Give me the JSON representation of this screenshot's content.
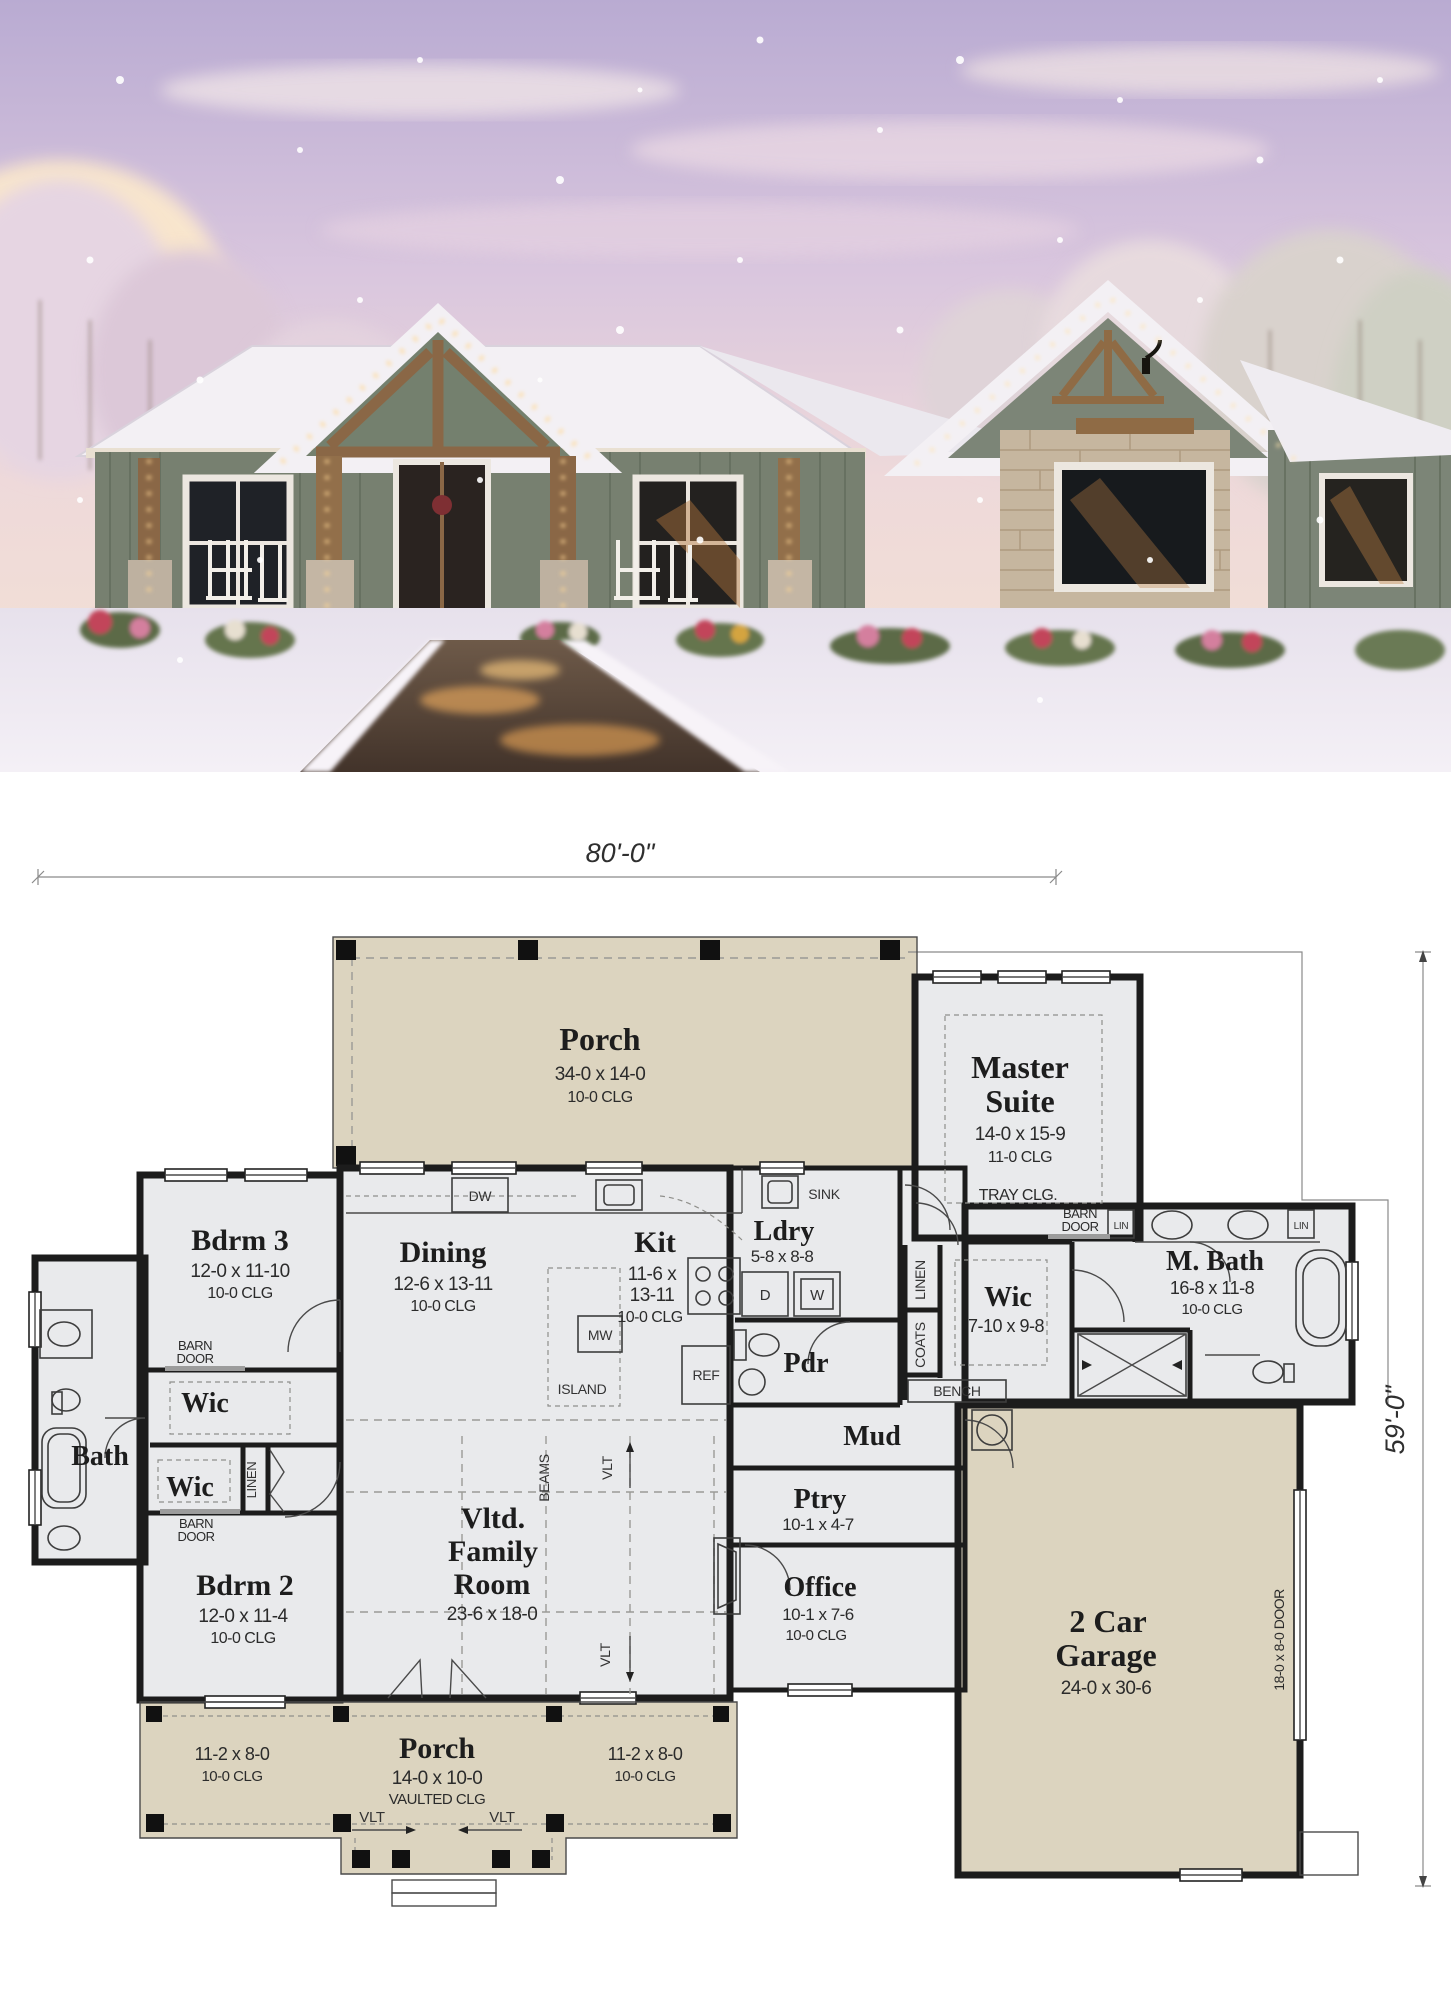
{
  "theme": {
    "porch_fill": "#dcd4bf",
    "room_fill": "#e9eaec",
    "wall_color": "#1c1c1c",
    "siding_green": "#778070",
    "stone_tan": "#c6b69f",
    "timber_brown": "#8a6746",
    "sky_lavender": "#c3b3d6",
    "glow_gold": "#ffd894"
  },
  "photo": {
    "description_icons": "snowy-craftsman-house-photo"
  },
  "plan": {
    "dims": {
      "top": "80'-0\"",
      "right": "59'-0\""
    },
    "rooms": {
      "porch_top": {
        "name": "Porch",
        "size": "34-0 x 14-0",
        "clg": "10-0 CLG"
      },
      "master": {
        "name1": "Master",
        "name2": "Suite",
        "size": "14-0 x 15-9",
        "clg": "11-0 CLG",
        "tray": "TRAY CLG."
      },
      "bdrm3": {
        "name": "Bdrm 3",
        "size": "12-0 x 11-10",
        "clg": "10-0 CLG"
      },
      "dining": {
        "name": "Dining",
        "size": "12-6 x 13-11",
        "clg": "10-0 CLG"
      },
      "kit": {
        "name": "Kit",
        "size1": "11-6 x",
        "size2": "13-11",
        "clg": "10-0 CLG"
      },
      "ldry": {
        "name": "Ldry",
        "size": "5-8 x 8-8"
      },
      "mbath": {
        "name": "M. Bath",
        "size": "16-8 x 11-8",
        "clg": "10-0 CLG"
      },
      "wic_master": {
        "name": "Wic",
        "size": "7-10 x 9-8"
      },
      "pdr": {
        "name": "Pdr"
      },
      "mud": {
        "name": "Mud"
      },
      "wic_upper": {
        "name": "Wic"
      },
      "bath": {
        "name": "Bath"
      },
      "wic_lower": {
        "name": "Wic"
      },
      "bdrm2": {
        "name": "Bdrm 2",
        "size": "12-0 x 11-4",
        "clg": "10-0 CLG"
      },
      "family": {
        "name1": "Vltd.",
        "name2": "Family",
        "name3": "Room",
        "size": "23-6 x 18-0"
      },
      "ptry": {
        "name": "Ptry",
        "size": "10-1 x 4-7"
      },
      "office": {
        "name": "Office",
        "size": "10-1 x 7-6",
        "clg": "10-0 CLG"
      },
      "garage": {
        "name1": "2 Car",
        "name2": "Garage",
        "size": "24-0 x 30-6",
        "door": "18-0 x 8-0 DOOR"
      },
      "porch_bottom": {
        "name": "Porch",
        "size": "14-0 x 10-0",
        "clg": "VAULTED CLG"
      },
      "porch_left": {
        "size": "11-2 x 8-0",
        "clg": "10-0 CLG"
      },
      "porch_right": {
        "size": "11-2 x 8-0",
        "clg": "10-0 CLG"
      }
    },
    "fix": {
      "dw": "DW",
      "sink": "SINK",
      "mw": "MW",
      "island": "ISLAND",
      "ref": "REF",
      "d": "D",
      "w": "W",
      "bench": "BENCH",
      "coats": "COATS",
      "linen": "LINEN",
      "lin": "LIN",
      "barn1": "BARN",
      "barn2": "DOOR",
      "vlt": "VLT",
      "beams": "BEAMS"
    }
  }
}
